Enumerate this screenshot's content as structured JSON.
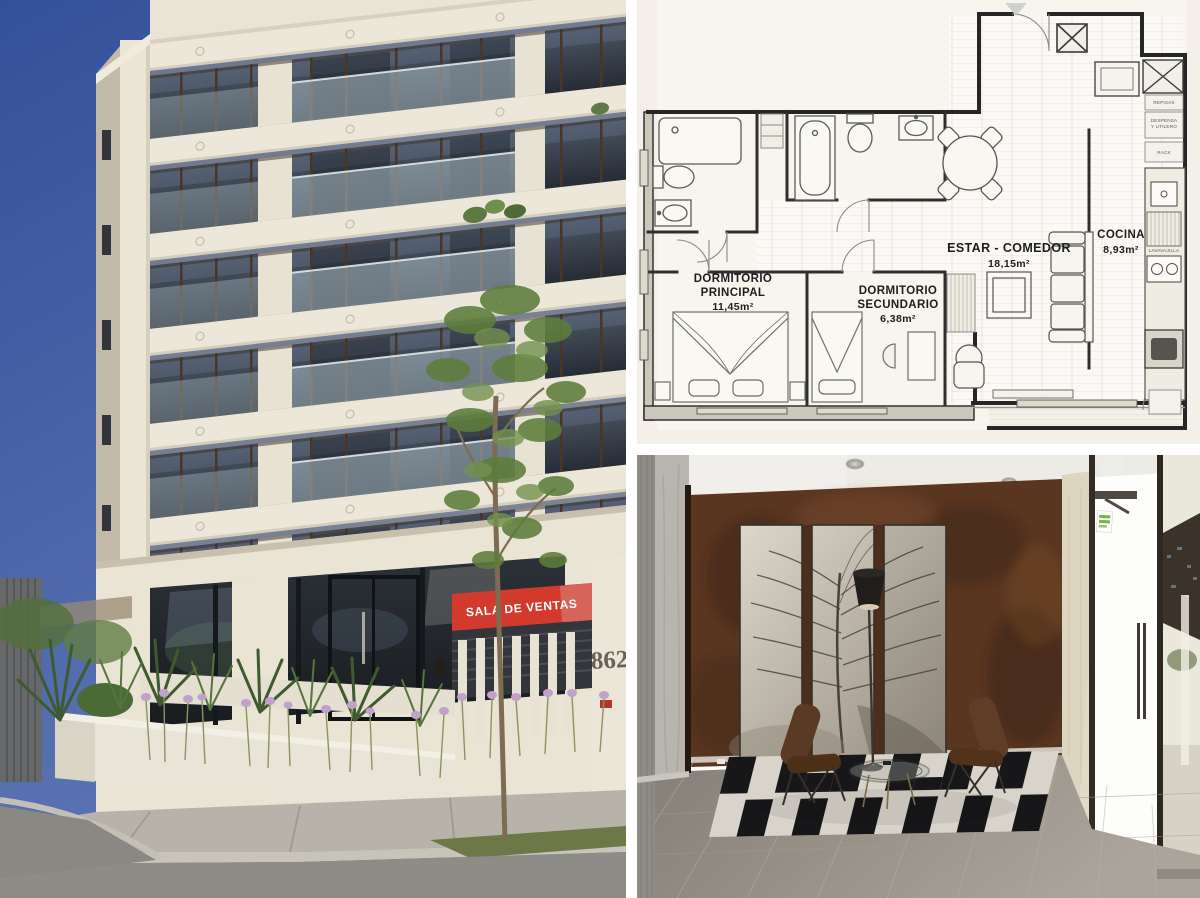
{
  "collage": {
    "background": "#ffffff",
    "tiles": [
      "building-exterior-photo",
      "floor-plan-drawing",
      "lobby-interior-photo"
    ]
  },
  "building": {
    "sales_sign": "SALA DE VENTAS",
    "street_number": "862",
    "colors": {
      "sky": "#3a57a0",
      "facade": "#ece7d8",
      "window_glass": "#2c323b",
      "sign_red": "#d23a2e",
      "foliage": "#5d7a42",
      "flowers": "#c1a0cb"
    }
  },
  "floorplan": {
    "paper_color": "#f7f4ee",
    "rooms": [
      {
        "id": "dormitorio-principal",
        "lines": [
          "DORMITORIO",
          "PRINCIPAL",
          "11,45m²"
        ]
      },
      {
        "id": "dormitorio-secundario",
        "lines": [
          "DORMITORIO",
          "SECUNDARIO",
          "6,38m²"
        ]
      },
      {
        "id": "estar-comedor",
        "lines": [
          "ESTAR - COMEDOR",
          "18,15m²"
        ]
      },
      {
        "id": "cocina",
        "lines": [
          "COCINA",
          "8,93m²"
        ]
      }
    ],
    "closet_labels": [
      {
        "id": "repisas",
        "lines": [
          "REPISAS"
        ]
      },
      {
        "id": "despensa",
        "lines": [
          "DESPENSA",
          "Y UTILERO"
        ]
      },
      {
        "id": "rack",
        "lines": [
          "RACK"
        ]
      },
      {
        "id": "lavavajilla",
        "lines": [
          "LAVAVAJILLA"
        ]
      }
    ]
  },
  "lobby": {
    "colors": {
      "feature_wall": "#5a3620",
      "ceiling": "#edebe6",
      "floor": "#97918a",
      "rug_dark": "#17171a",
      "rug_light": "#d9d4cb",
      "chair_leather": "#5a3a24",
      "exit_sticker_green": "#7ab648"
    }
  }
}
